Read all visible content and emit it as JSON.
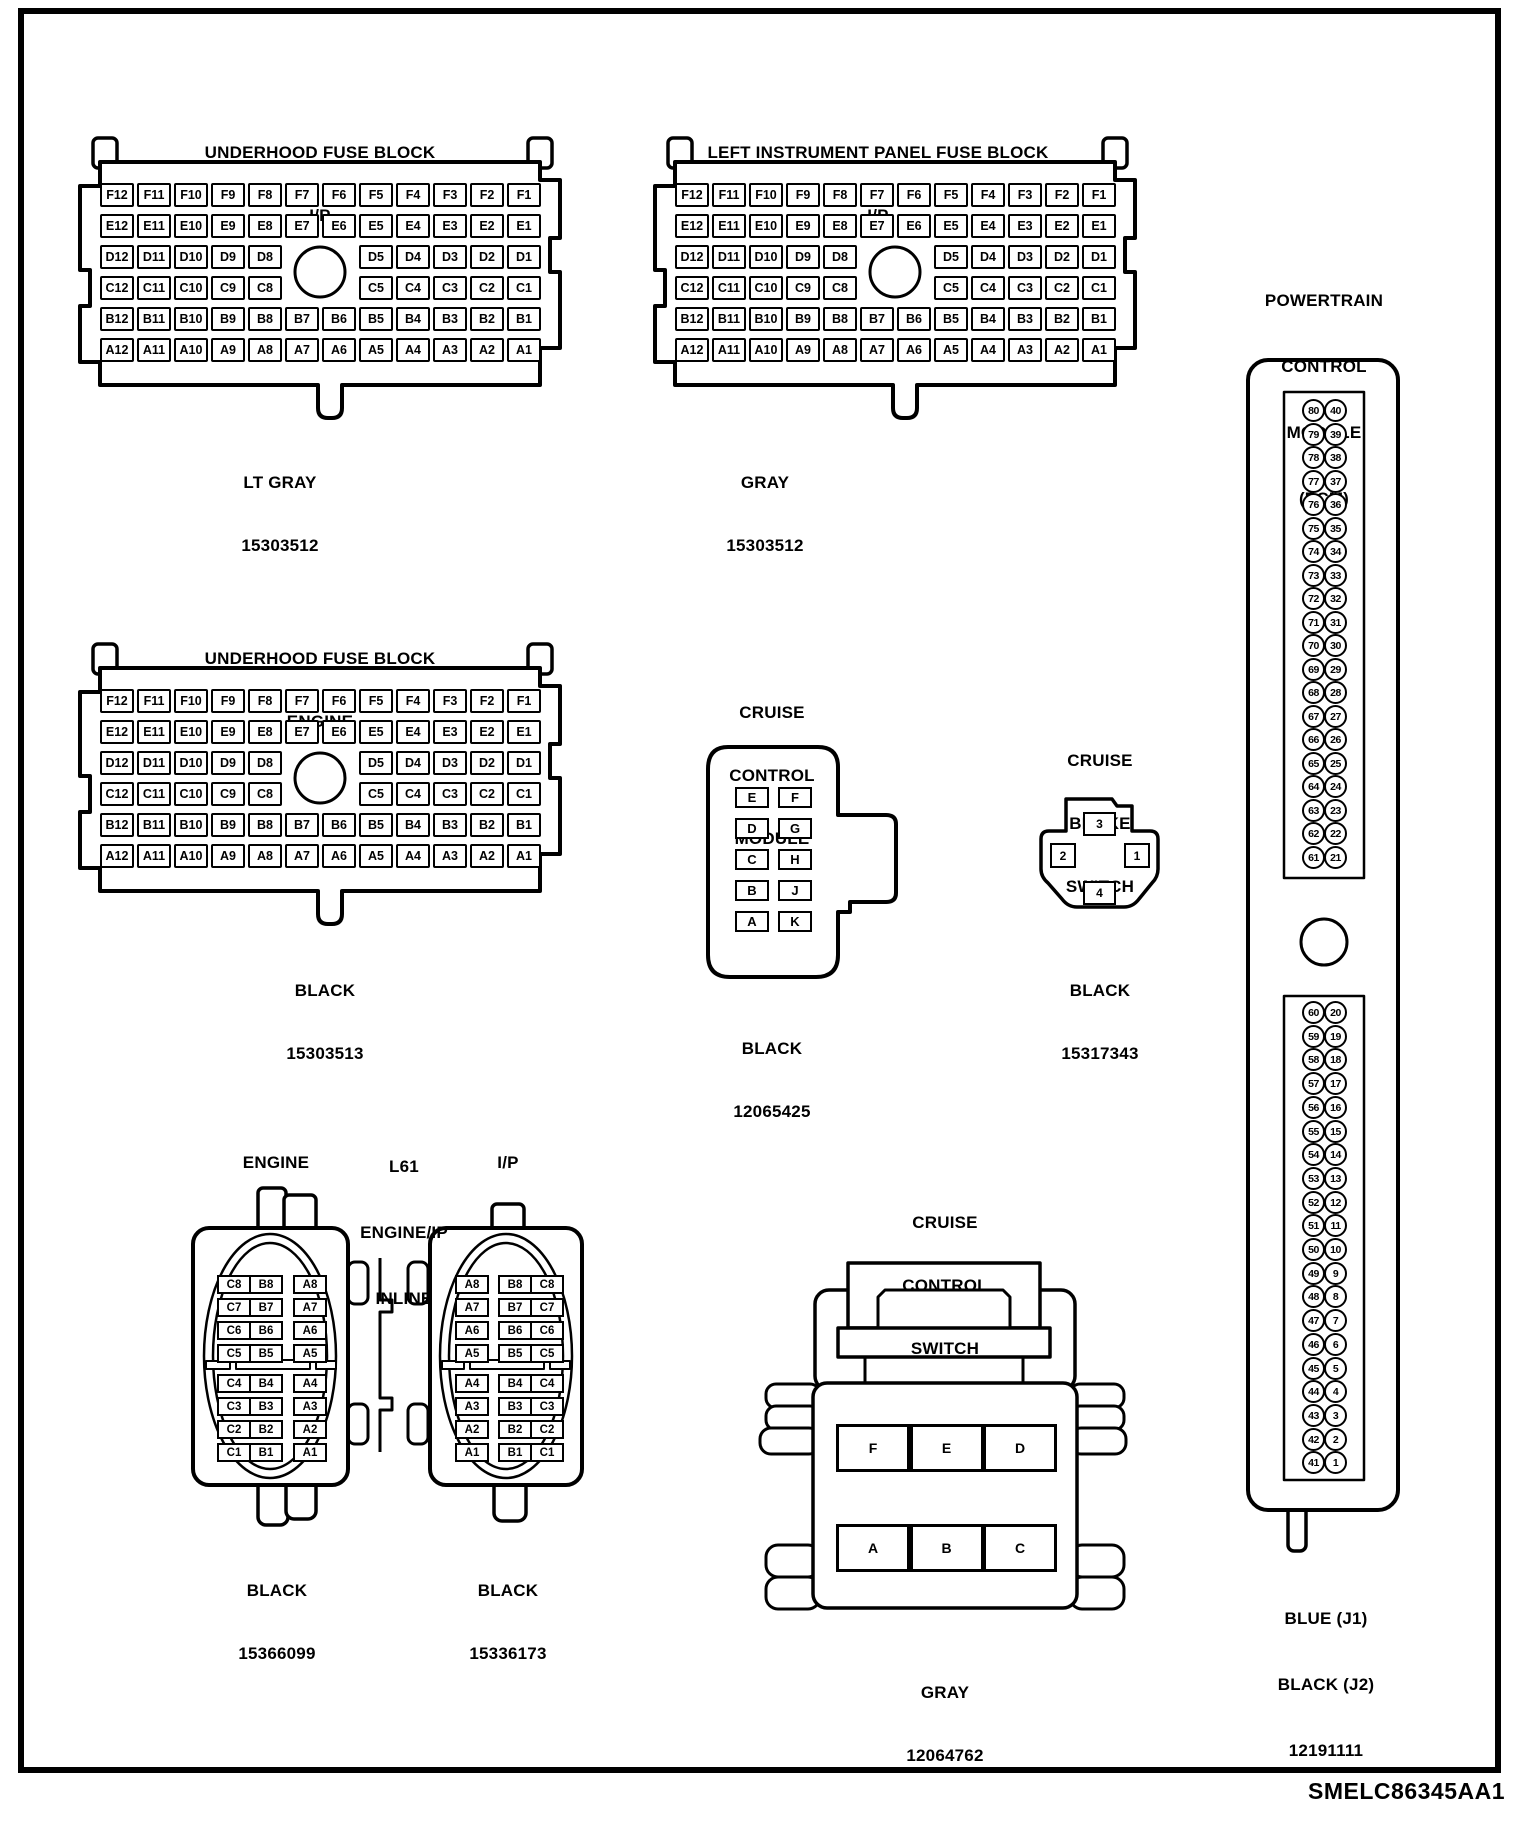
{
  "page": {
    "footer_id": "SMELC86345AA1",
    "ink_color": "#000000",
    "paper_color": "#ffffff"
  },
  "fuse_grid": {
    "rows": [
      [
        "F12",
        "F11",
        "F10",
        "F9",
        "F8",
        "F7",
        "F6",
        "F5",
        "F4",
        "F3",
        "F2",
        "F1"
      ],
      [
        "E12",
        "E11",
        "E10",
        "E9",
        "E8",
        "E7",
        "E6",
        "E5",
        "E4",
        "E3",
        "E2",
        "E1"
      ],
      [
        "D12",
        "D11",
        "D10",
        "D9",
        "D8",
        null,
        null,
        "D5",
        "D4",
        "D3",
        "D2",
        "D1"
      ],
      [
        "C12",
        "C11",
        "C10",
        "C9",
        "C8",
        null,
        null,
        "C5",
        "C4",
        "C3",
        "C2",
        "C1"
      ],
      [
        "B12",
        "B11",
        "B10",
        "B9",
        "B8",
        "B7",
        "B6",
        "B5",
        "B4",
        "B3",
        "B2",
        "B1"
      ],
      [
        "A12",
        "A11",
        "A10",
        "A9",
        "A8",
        "A7",
        "A6",
        "A5",
        "A4",
        "A3",
        "A2",
        "A1"
      ]
    ]
  },
  "fuse_blocks": [
    {
      "title_lines": [
        "UNDERHOOD FUSE BLOCK",
        "I/P"
      ],
      "label_lines": [
        "LT GRAY",
        "15303512"
      ]
    },
    {
      "title_lines": [
        "LEFT INSTRUMENT PANEL FUSE BLOCK",
        "I/P"
      ],
      "label_lines": [
        "GRAY",
        "15303512"
      ]
    },
    {
      "title_lines": [
        "UNDERHOOD FUSE BLOCK",
        "ENGINE"
      ],
      "label_lines": [
        "BLACK",
        "15303513"
      ]
    }
  ],
  "pcm": {
    "title_lines": [
      "POWERTRAIN",
      "CONTROL",
      "MODULE",
      "(PCM)"
    ],
    "label_lines": [
      "BLUE (J1)",
      "BLACK (J2)",
      "12191111"
    ],
    "top_pin_pairs": [
      [
        80,
        40
      ],
      [
        79,
        39
      ],
      [
        78,
        38
      ],
      [
        77,
        37
      ],
      [
        76,
        36
      ],
      [
        75,
        35
      ],
      [
        74,
        34
      ],
      [
        73,
        33
      ],
      [
        72,
        32
      ],
      [
        71,
        31
      ],
      [
        70,
        30
      ],
      [
        69,
        29
      ],
      [
        68,
        28
      ],
      [
        67,
        27
      ],
      [
        66,
        26
      ],
      [
        65,
        25
      ],
      [
        64,
        24
      ],
      [
        63,
        23
      ],
      [
        62,
        22
      ],
      [
        61,
        21
      ]
    ],
    "bottom_pin_pairs": [
      [
        60,
        20
      ],
      [
        59,
        19
      ],
      [
        58,
        18
      ],
      [
        57,
        17
      ],
      [
        56,
        16
      ],
      [
        55,
        15
      ],
      [
        54,
        14
      ],
      [
        53,
        13
      ],
      [
        52,
        12
      ],
      [
        51,
        11
      ],
      [
        50,
        10
      ],
      [
        49,
        9
      ],
      [
        48,
        8
      ],
      [
        47,
        7
      ],
      [
        46,
        6
      ],
      [
        45,
        5
      ],
      [
        44,
        4
      ],
      [
        43,
        3
      ],
      [
        42,
        2
      ],
      [
        41,
        1
      ]
    ]
  },
  "cruise_module": {
    "title_lines": [
      "CRUISE",
      "CONTROL",
      "MODULE"
    ],
    "label_lines": [
      "BLACK",
      "12065425"
    ],
    "pin_rows": [
      [
        "E",
        "F"
      ],
      [
        "D",
        "G"
      ],
      [
        "C",
        "H"
      ],
      [
        "B",
        "J"
      ],
      [
        "A",
        "K"
      ]
    ]
  },
  "brake_switch": {
    "title_lines": [
      "CRUISE",
      "BRAKE",
      "SWITCH"
    ],
    "label_lines": [
      "BLACK",
      "15317343"
    ],
    "pins": {
      "top": "3",
      "left": "2",
      "right": "1",
      "bottom": "4"
    }
  },
  "inline": {
    "engine_title": "ENGINE",
    "inline_title_lines": [
      "L61",
      "ENGINE/IP",
      "INLINE"
    ],
    "ip_title": "I/P",
    "engine": {
      "label_lines": [
        "BLACK",
        "15366099"
      ],
      "rows": [
        [
          "C8",
          "B8",
          "A8"
        ],
        [
          "C7",
          "B7",
          "A7"
        ],
        [
          "C6",
          "B6",
          "A6"
        ],
        [
          "C5",
          "B5",
          "A5"
        ],
        [
          "C4",
          "B4",
          "A4"
        ],
        [
          "C3",
          "B3",
          "A3"
        ],
        [
          "C2",
          "B2",
          "A2"
        ],
        [
          "C1",
          "B1",
          "A1"
        ]
      ]
    },
    "ip": {
      "label_lines": [
        "BLACK",
        "15336173"
      ],
      "rows": [
        [
          "A8",
          "B8",
          "C8"
        ],
        [
          "A7",
          "B7",
          "C7"
        ],
        [
          "A6",
          "B6",
          "C6"
        ],
        [
          "A5",
          "B5",
          "C5"
        ],
        [
          "A4",
          "B4",
          "C4"
        ],
        [
          "A3",
          "B3",
          "C3"
        ],
        [
          "A2",
          "B2",
          "C2"
        ],
        [
          "A1",
          "B1",
          "C1"
        ]
      ]
    }
  },
  "cruise_switch": {
    "title_lines": [
      "CRUISE",
      "CONTROL",
      "SWITCH"
    ],
    "label_lines": [
      "GRAY",
      "12064762"
    ],
    "pin_rows": [
      [
        "F",
        "E",
        "D"
      ],
      [
        "A",
        "B",
        "C"
      ]
    ]
  }
}
